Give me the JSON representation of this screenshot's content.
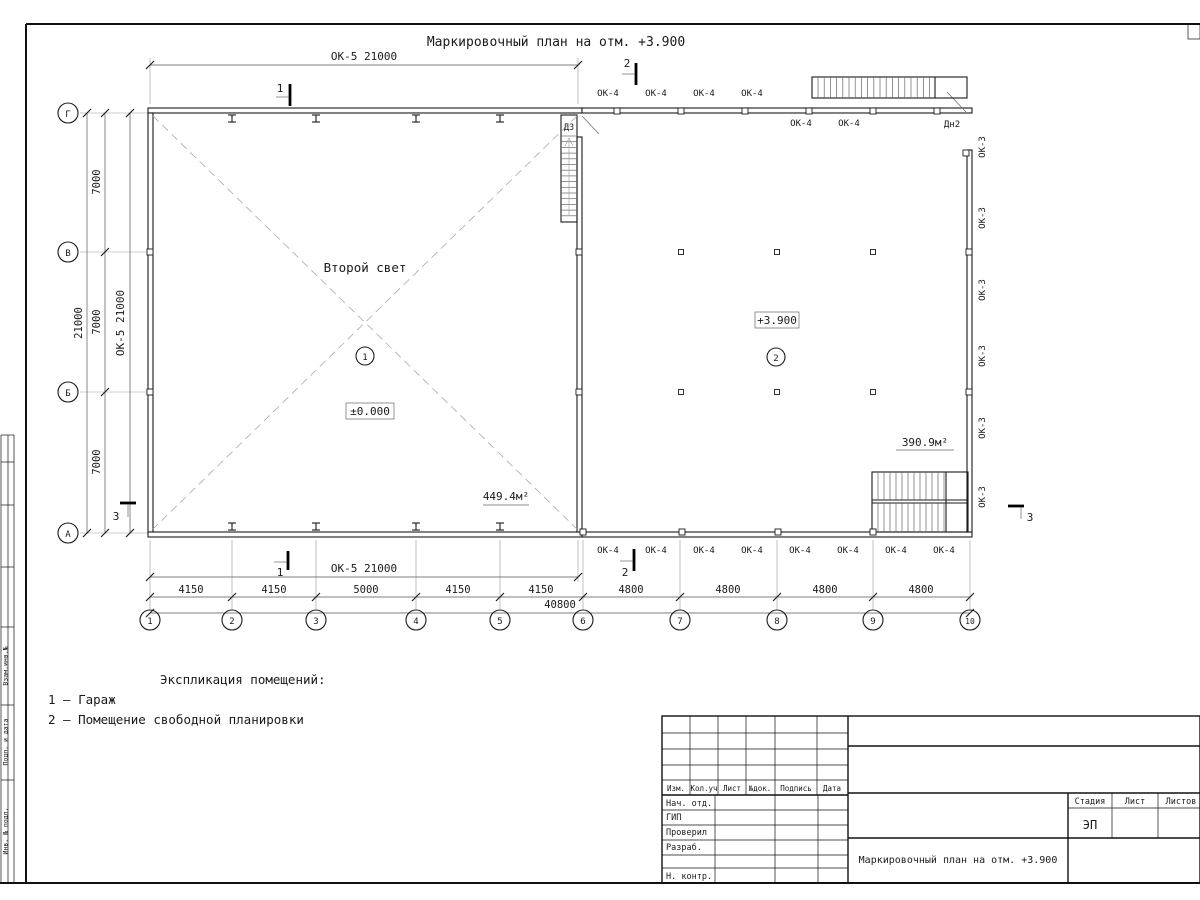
{
  "sheet": {
    "title": "Маркировочный план на отм. +3.900"
  },
  "plan": {
    "axes": {
      "horizontal": [
        "1",
        "2",
        "3",
        "4",
        "5",
        "6",
        "7",
        "8",
        "9",
        "10"
      ],
      "vertical": [
        "Г",
        "В",
        "Б",
        "А"
      ]
    },
    "dims": {
      "top_band": "ОК-5 21000",
      "bottom_band": "ОК-5 21000",
      "left_band": "ОК-5 21000",
      "left_chain": [
        "7000",
        "7000",
        "7000"
      ],
      "left_total": "21000",
      "bottom_chain": [
        "4150",
        "4150",
        "5000",
        "4150",
        "4150",
        "4800",
        "4800",
        "4800",
        "4800"
      ],
      "bottom_total": "40800"
    },
    "windows": {
      "top_above": [
        "ОК-4",
        "ОК-4",
        "ОК-4",
        "ОК-4"
      ],
      "top_below": [
        "ОК-4",
        "ОК-4"
      ],
      "bottom": [
        "ОК-4",
        "ОК-4",
        "ОК-4",
        "ОК-4",
        "ОК-4",
        "ОК-4",
        "ОК-4",
        "ОК-4"
      ],
      "right": [
        "ОК-3",
        "ОК-3",
        "ОК-3",
        "ОК-3",
        "ОК-3",
        "ОК-3"
      ]
    },
    "doors": {
      "stair_door": "ДЗ",
      "entry_door": "Дн2"
    },
    "sections": {
      "s1": "1",
      "s2": "2",
      "s3": "3"
    },
    "rooms": {
      "room1": {
        "number": "1",
        "note": "Второй свет",
        "level": "±0.000",
        "area": "449.4м²"
      },
      "room2": {
        "number": "2",
        "level": "+3.900",
        "area": "390.9м²"
      }
    }
  },
  "legend": {
    "heading": "Экспликация помещений:",
    "items": [
      "1 – Гараж",
      "2 – Помещение свободной планировки"
    ]
  },
  "title_block": {
    "revision_headers": [
      "Изм.",
      "Кол.уч",
      "Лист",
      "№док.",
      "Подпись",
      "Дата"
    ],
    "staff_rows": [
      "Нач. отд.",
      "ГИП",
      "Проверил",
      "Разраб.",
      "",
      "Н. контр."
    ],
    "stage_headers": [
      "Стадия",
      "Лист",
      "Листов"
    ],
    "stage_value": "ЭП",
    "drawing_title": "Маркировочный план на отм. +3.900"
  },
  "side_strip": {
    "labels": [
      "Взам.инв.№",
      "Подп. и дата",
      "Инв. № подл."
    ]
  }
}
